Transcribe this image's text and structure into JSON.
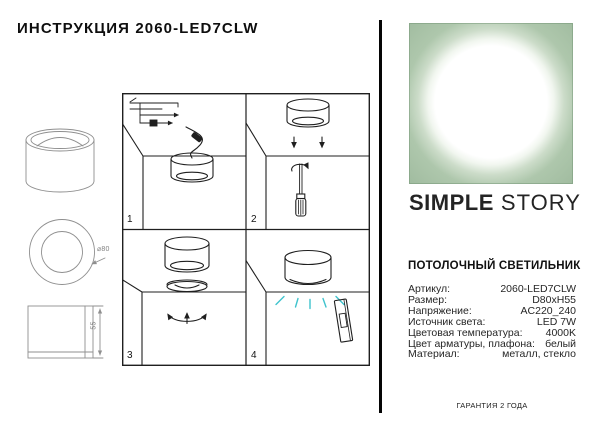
{
  "title": "ИНСТРУКЦИЯ 2060-LED7CLW",
  "drawings": {
    "diameter_label": "⌀80",
    "height_label": "55"
  },
  "panels": [
    {
      "number": "1"
    },
    {
      "number": "2"
    },
    {
      "number": "3"
    },
    {
      "number": "4"
    }
  ],
  "brand": {
    "logo_primary": "SIMPLE",
    "logo_secondary": "STORY"
  },
  "product": {
    "heading": "ПОТОЛОЧНЫЙ СВЕТИЛЬНИК",
    "specs": [
      {
        "label": "Артикул:",
        "value": "2060-LED7CLW"
      },
      {
        "label": "Размер:",
        "value": "D80xH55"
      },
      {
        "label": "Напряжение:",
        "value": "AC220_240"
      },
      {
        "label": "Источник света:",
        "value": "LED 7W"
      },
      {
        "label": "Цветовая температура:",
        "value": "4000K"
      },
      {
        "label": "Цвет арматуры, плафона:",
        "value": "белый"
      },
      {
        "label": "Материал:",
        "value": "металл, стекло"
      }
    ]
  },
  "footer": {
    "warranty": "ГАРАНТИЯ 2 ГОДА"
  },
  "colors": {
    "light_ray": "#3fc3cd",
    "photo_sage": "#9ab69a",
    "line_dark": "#1f1f1f",
    "line_gray": "#8f8f8f"
  }
}
